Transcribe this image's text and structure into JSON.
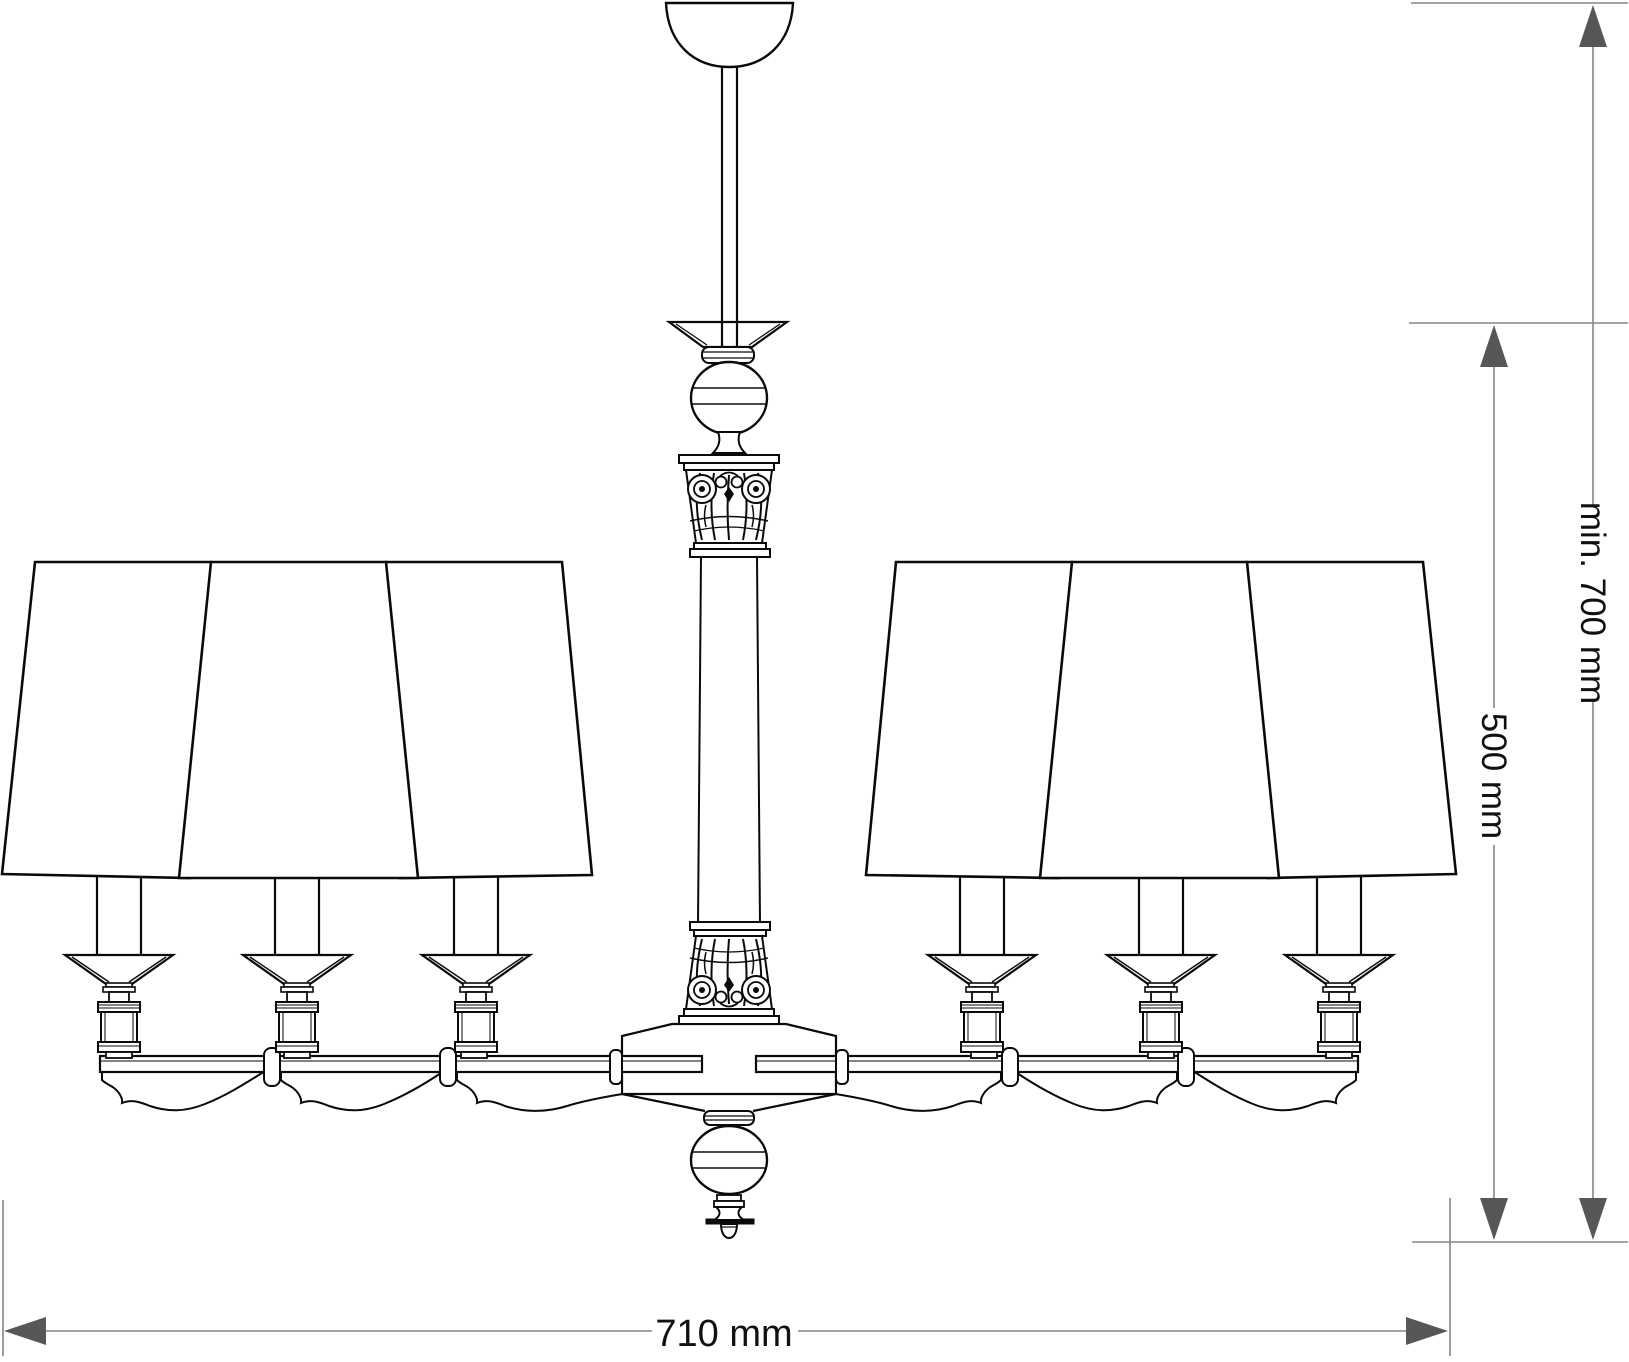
{
  "drawing": {
    "subject": "six-arm chandelier with trapezoid lamp shades, front elevation technical line drawing",
    "background_color": "#ffffff",
    "line_color": "#0a0a0a",
    "dimension_line_color": "#868686",
    "arrow_color": "#575757",
    "text_color": "#111111"
  },
  "dimensions": {
    "height_min": {
      "label": "min. 700 mm",
      "value": 700,
      "unit": "mm",
      "orientation": "vertical"
    },
    "height_body": {
      "label": "500 mm",
      "value": 500,
      "unit": "mm",
      "orientation": "vertical"
    },
    "width": {
      "label": "710 mm",
      "value": 710,
      "unit": "mm",
      "orientation": "horizontal"
    }
  }
}
